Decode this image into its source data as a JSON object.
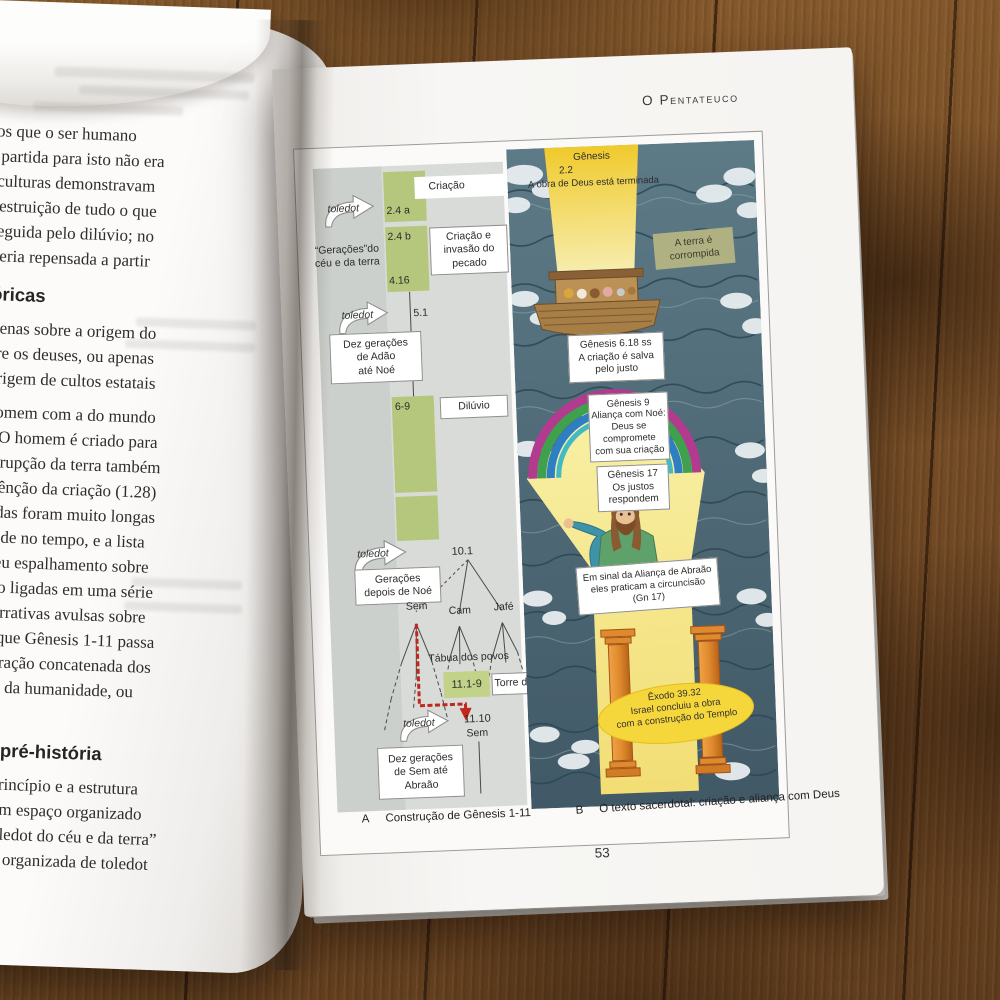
{
  "book": {
    "left_page": {
      "para1": [
        "s indícios que o ser humano",
        "onto de partida para isto não era",
        "iversas culturas demonstravam",
        "entual destruição de tudo o que",
        "é logo seguida pelo dilúvio; no",
        "nidade seria repensada a partir"
      ],
      "heading1": "é-históricas",
      "para2": [
        "falam apenas sobre a origem do",
        "rária entre os deuses, ou apenas",
        "icam a origem de cultos estatais"
      ],
      "para3": [
        "ção do homem com a do mundo",
        "anidade. O homem é criado para",
        "sso, a corrupção da terra também",
        "tanto, a bênção da criação (1.28)",
        ", cujas vidas foram muito longas",
        "humanidade no tempo, e a lista",
        "relata o seu espalhamento sobre",
        "listas estão ligadas em uma série",
        "antigas narrativas avulsas sobre",
        "tal forma que Gênesis 1-11 passa",
        "no um narração concatenada dos",
        "o mundo e da humanidade, ou",
        "é-história."
      ],
      "heading2": "ções de pré-história",
      "para4": [
        "(P) são o princípio e a estrutura",
        "eus criou um espaço organizado",
        "como o “toledot do céu e da terra”",
        "igualmente organizada de toledot",
        "manidade:"
      ]
    },
    "right_page": {
      "header": "O Pentateuco",
      "page_number": "53",
      "panel_a": {
        "caption_letter": "A",
        "caption": "Construção de Gênesis 1-11",
        "toledot": "toledot",
        "criacao": "Criação",
        "ref_24a": "2.4 a",
        "ref_24b": "2.4 b",
        "geracoes_ceu": "“Gerações”do",
        "geracoes_terra": "céu e da terra",
        "criacao_invasao": [
          "Criação e",
          "invasão do",
          "pecado"
        ],
        "ref_416": "4.16",
        "ref_51": "5.1",
        "dez_adao": [
          "Dez gerações",
          "de Adão",
          "até Noé"
        ],
        "ref_69": "6-9",
        "diluvio": "Dilúvio",
        "ref_101": "10.1",
        "geracoes_noe": [
          "Gerações",
          "depois de Noé"
        ],
        "sem": "Sem",
        "cam": "Cam",
        "jafe": "Jafé",
        "tabua": "Tábua dos povos",
        "ref_1119": "11.1-9",
        "torre": "Torre de Babel",
        "ref_1110": "11.10",
        "sem2": "Sem",
        "dez_sem": [
          "Dez gerações",
          "de Sem até",
          "Abraão"
        ]
      },
      "panel_b": {
        "caption_letter": "B",
        "caption": "O texto sacerdotal: criação e aliança com Deus",
        "gen22_book": "Gênesis",
        "gen22_ref": "2.2",
        "gen22_text": "A obra de Deus está terminada",
        "terra_corrompida": [
          "A terra é",
          "corrompida"
        ],
        "gen618": [
          "Gênesis 6.18 ss",
          "A criação é salva",
          "pelo justo"
        ],
        "gen9": [
          "Gênesis 9",
          "Aliança com Noé:",
          "Deus se",
          "compromete",
          "com sua criação"
        ],
        "gen17": [
          "Gênesis 17",
          "Os justos",
          "respondem"
        ],
        "sinal": [
          "Em sinal da Aliança de Abraão",
          "eles praticam a circuncisão",
          "(Gn 17)"
        ],
        "exodo": [
          "Êxodo 39.32",
          "Israel concluiu a obra",
          "com a construção do Templo"
        ]
      }
    }
  }
}
